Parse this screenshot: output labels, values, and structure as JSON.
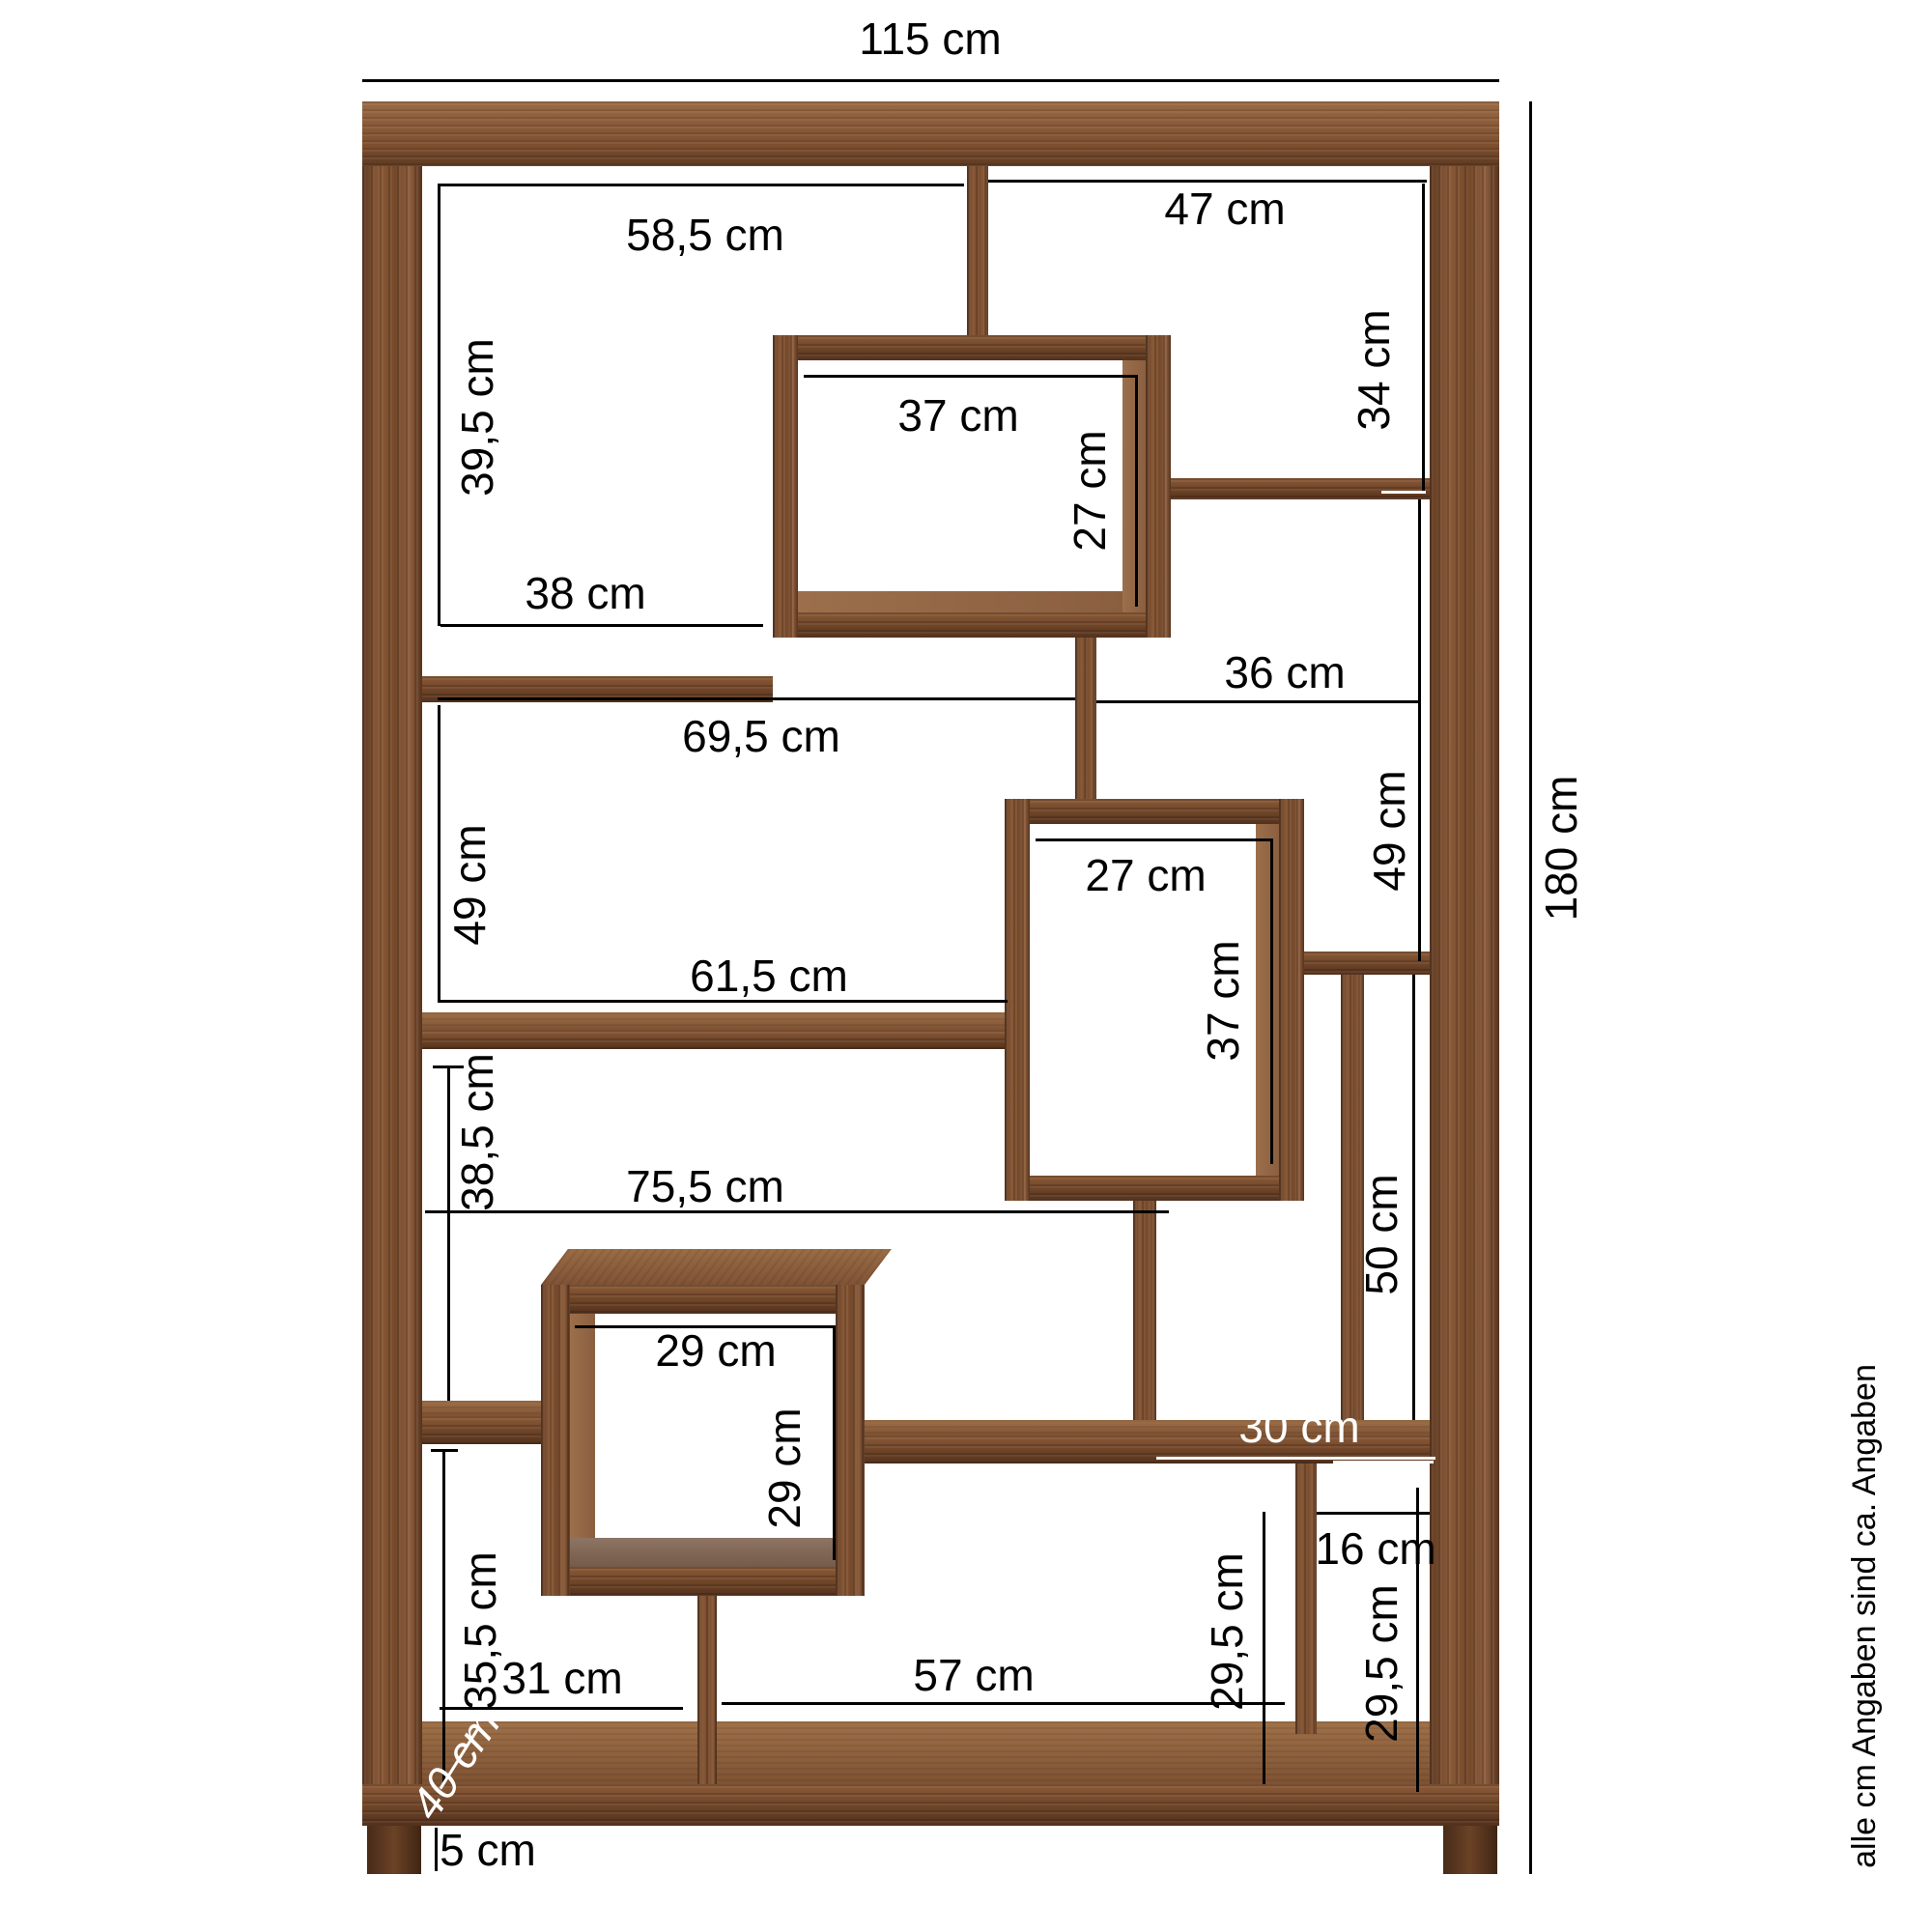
{
  "figure": {
    "type": "furniture-dimension-diagram",
    "subject": "wooden staggered cube shelf (room divider) with measurement annotations"
  },
  "units": "cm",
  "overall": {
    "width": "115 cm",
    "height": "180 cm",
    "depth": "40 cm",
    "foot_height": "5 cm"
  },
  "dims": {
    "w115": {
      "text": "115 cm"
    },
    "h180": {
      "text": "180 cm"
    },
    "a585": {
      "text": "58,5 cm"
    },
    "a47": {
      "text": "47 cm"
    },
    "a395": {
      "text": "39,5 cm"
    },
    "a34": {
      "text": "34 cm"
    },
    "b37": {
      "text": "37 cm"
    },
    "b27": {
      "text": "27 cm"
    },
    "a38": {
      "text": "38 cm"
    },
    "m36": {
      "text": "36 cm"
    },
    "m695": {
      "text": "69,5 cm"
    },
    "l49": {
      "text": "49 cm"
    },
    "r49": {
      "text": "49 cm"
    },
    "c27": {
      "text": "27 cm"
    },
    "c37": {
      "text": "37 cm"
    },
    "m615": {
      "text": "61,5 cm"
    },
    "l385": {
      "text": "38,5 cm"
    },
    "m755": {
      "text": "75,5 cm"
    },
    "d29": {
      "text": "29 cm"
    },
    "d29v": {
      "text": "29 cm"
    },
    "q50": {
      "text": "50 cm"
    },
    "r30": {
      "text": "30 cm"
    },
    "r16": {
      "text": "16 cm"
    },
    "q295a": {
      "text": "29,5 cm"
    },
    "q295b": {
      "text": "29,5 cm"
    },
    "b57": {
      "text": "57 cm"
    },
    "b31": {
      "text": "31 cm"
    },
    "l355": {
      "text": "35,5 cm"
    },
    "dep40": {
      "text": "40 cm"
    },
    "f5": {
      "text": "5 cm"
    }
  },
  "footnote": {
    "text": "alle cm Angaben sind ca. Angaben"
  },
  "colors": {
    "annotation_line": "#000000",
    "annotation_on_wood": "#ffffff",
    "background": "#ffffff",
    "wood_dark": "#5e3a22",
    "wood_mid": "#7c4e2e",
    "wood_light": "#9a6a45"
  }
}
